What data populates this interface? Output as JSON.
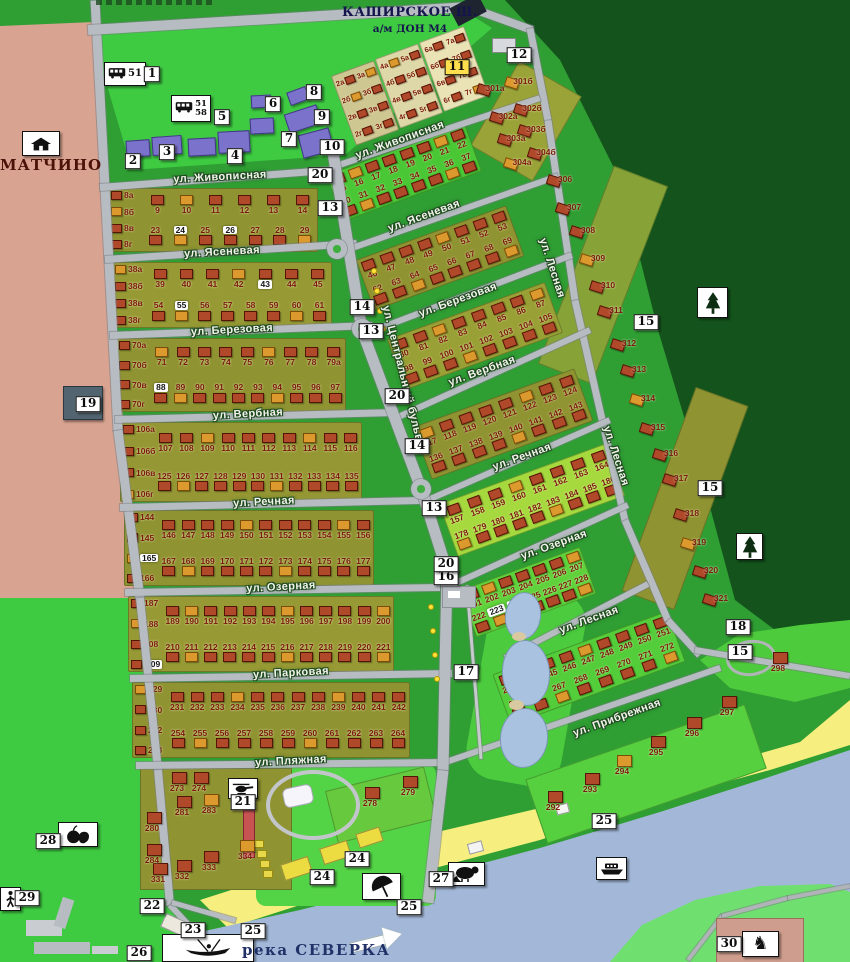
{
  "canvas": {
    "width": 850,
    "height": 962
  },
  "palette": {
    "grass_bright": "#3ecb42",
    "grass_mid": "#2f9e33",
    "forest": "#14541c",
    "settlement_pink": "#d8a391",
    "water": "#a3b8d8",
    "beach": "#f6ee7e",
    "road": "#b7bcc2",
    "plot_olive": "#8f9331",
    "plot_lime": "#b6e33c",
    "plot_green": "#46c834",
    "house_brick": "#b0482a",
    "house_orange": "#dc9a2e",
    "building_violet": "#7b72cc",
    "number_maroon": "#7a190d",
    "label_navy": "#15154d"
  },
  "header": {
    "highway": "КАШИРСКОЕ Ш.",
    "highway_sub": "а/м ДОН М4"
  },
  "places": {
    "village": "МАТЧИНО",
    "river": "река СЕВЕРКА"
  },
  "bus_stops": [
    {
      "routes": "51",
      "x": 104,
      "y": 62,
      "w": 42,
      "h": 24
    },
    {
      "routes": "51/58",
      "x": 171,
      "y": 95,
      "w": 40,
      "h": 27
    }
  ],
  "street_labels": [
    {
      "text": "ул. Живописная",
      "x": 220,
      "y": 177,
      "rot": -3
    },
    {
      "text": "ул. Ясеневая",
      "x": 222,
      "y": 252,
      "rot": -3
    },
    {
      "text": "ул. Березовая",
      "x": 232,
      "y": 330,
      "rot": -3
    },
    {
      "text": "ул. Вербная",
      "x": 248,
      "y": 414,
      "rot": -3
    },
    {
      "text": "ул. Речная",
      "x": 264,
      "y": 502,
      "rot": -3
    },
    {
      "text": "ул. Озерная",
      "x": 281,
      "y": 587,
      "rot": -3
    },
    {
      "text": "ул. Парковая",
      "x": 291,
      "y": 673,
      "rot": -3
    },
    {
      "text": "ул. Пляжная",
      "x": 291,
      "y": 761,
      "rot": -3
    },
    {
      "text": "ул. Живописная",
      "x": 400,
      "y": 140,
      "rot": -20
    },
    {
      "text": "ул. Ясеневая",
      "x": 424,
      "y": 216,
      "rot": -20
    },
    {
      "text": "ул. Березовая",
      "x": 458,
      "y": 300,
      "rot": -20
    },
    {
      "text": "ул. Вербная",
      "x": 482,
      "y": 371,
      "rot": -20
    },
    {
      "text": "ул. Речная",
      "x": 522,
      "y": 457,
      "rot": -20
    },
    {
      "text": "ул. Озерная",
      "x": 554,
      "y": 545,
      "rot": -20
    },
    {
      "text": "ул. Лесная",
      "x": 589,
      "y": 620,
      "rot": -20
    },
    {
      "text": "ул. Прибрежная",
      "x": 617,
      "y": 718,
      "rot": -20
    },
    {
      "text": "ул. Центральный бульвар",
      "x": 404,
      "y": 380,
      "rot": 76
    },
    {
      "text": "ул. Лесная",
      "x": 552,
      "y": 268,
      "rot": 72
    },
    {
      "text": "ул. Лесная",
      "x": 616,
      "y": 456,
      "rot": 72
    }
  ],
  "markers": [
    {
      "n": "1",
      "x": 152,
      "y": 74
    },
    {
      "n": "2",
      "x": 133,
      "y": 161
    },
    {
      "n": "3",
      "x": 167,
      "y": 152
    },
    {
      "n": "4",
      "x": 235,
      "y": 156
    },
    {
      "n": "5",
      "x": 222,
      "y": 117
    },
    {
      "n": "6",
      "x": 273,
      "y": 104
    },
    {
      "n": "7",
      "x": 289,
      "y": 139
    },
    {
      "n": "8",
      "x": 314,
      "y": 92
    },
    {
      "n": "9",
      "x": 322,
      "y": 117
    },
    {
      "n": "10",
      "x": 332,
      "y": 147
    },
    {
      "n": "11",
      "x": 457,
      "y": 67,
      "accent": true
    },
    {
      "n": "12",
      "x": 519,
      "y": 55
    },
    {
      "n": "13",
      "x": 330,
      "y": 208
    },
    {
      "n": "13",
      "x": 371,
      "y": 331
    },
    {
      "n": "13",
      "x": 434,
      "y": 508
    },
    {
      "n": "14",
      "x": 362,
      "y": 307
    },
    {
      "n": "14",
      "x": 417,
      "y": 446
    },
    {
      "n": "15",
      "x": 646,
      "y": 322
    },
    {
      "n": "15",
      "x": 710,
      "y": 488
    },
    {
      "n": "15",
      "x": 740,
      "y": 652
    },
    {
      "n": "16",
      "x": 446,
      "y": 577
    },
    {
      "n": "17",
      "x": 466,
      "y": 672
    },
    {
      "n": "18",
      "x": 738,
      "y": 627
    },
    {
      "n": "19",
      "x": 88,
      "y": 404
    },
    {
      "n": "20",
      "x": 320,
      "y": 175
    },
    {
      "n": "20",
      "x": 397,
      "y": 396
    },
    {
      "n": "20",
      "x": 446,
      "y": 564
    },
    {
      "n": "21",
      "x": 243,
      "y": 802
    },
    {
      "n": "22",
      "x": 152,
      "y": 906
    },
    {
      "n": "23",
      "x": 193,
      "y": 930
    },
    {
      "n": "24",
      "x": 357,
      "y": 859
    },
    {
      "n": "24",
      "x": 322,
      "y": 877
    },
    {
      "n": "25",
      "x": 604,
      "y": 821
    },
    {
      "n": "25",
      "x": 409,
      "y": 907
    },
    {
      "n": "25",
      "x": 253,
      "y": 931
    },
    {
      "n": "26",
      "x": 139,
      "y": 953
    },
    {
      "n": "27",
      "x": 441,
      "y": 879
    },
    {
      "n": "28",
      "x": 48,
      "y": 841
    },
    {
      "n": "29",
      "x": 27,
      "y": 898
    },
    {
      "n": "30",
      "x": 729,
      "y": 944
    }
  ],
  "icon_boxes": [
    {
      "icon": "house-icon",
      "x": 22,
      "y": 131,
      "w": 38,
      "h": 25
    },
    {
      "icon": "tree-icon",
      "x": 697,
      "y": 287,
      "w": 31,
      "h": 31
    },
    {
      "icon": "tree-icon",
      "x": 736,
      "y": 533,
      "w": 27,
      "h": 27
    },
    {
      "icon": "helicopter-icon",
      "x": 228,
      "y": 778,
      "w": 30,
      "h": 21
    },
    {
      "icon": "produce-icon",
      "x": 58,
      "y": 822,
      "w": 40,
      "h": 25
    },
    {
      "icon": "pedestrian-icon",
      "x": 0,
      "y": 887,
      "w": 21,
      "h": 24
    },
    {
      "icon": "beaver-icon",
      "x": 448,
      "y": 862,
      "w": 37,
      "h": 24
    },
    {
      "icon": "umbrella-icon",
      "x": 362,
      "y": 873,
      "w": 39,
      "h": 27
    },
    {
      "icon": "boat-icon",
      "x": 596,
      "y": 857,
      "w": 31,
      "h": 23
    },
    {
      "icon": "horse-icon",
      "x": 742,
      "y": 931,
      "w": 37,
      "h": 26
    },
    {
      "icon": "rowboat-icon",
      "x": 162,
      "y": 934,
      "w": 92,
      "h": 28
    }
  ],
  "plots": {
    "highlighted": [
      "24",
      "26",
      "43",
      "55",
      "88",
      "165",
      "209",
      "223",
      "224",
      "244"
    ],
    "left_blocks": [
      {
        "x": 108,
        "y": 188,
        "w": 210,
        "h": 64,
        "bg": "#8f9331",
        "stack": [
          "8а",
          "8б",
          "8в",
          "8г"
        ],
        "row1": [
          "9",
          "10",
          "11",
          "12",
          "13",
          "14"
        ],
        "row2": [
          "23",
          "24",
          "25",
          "26",
          "27",
          "28",
          "29"
        ]
      },
      {
        "x": 112,
        "y": 262,
        "w": 220,
        "h": 66,
        "bg": "#979a34",
        "stack": [
          "38а",
          "38б",
          "38в",
          "38г"
        ],
        "row1": [
          "39",
          "40",
          "41",
          "42",
          "43",
          "44",
          "45"
        ],
        "row2": [
          "54",
          "55",
          "56",
          "57",
          "58",
          "59",
          "60",
          "61"
        ]
      },
      {
        "x": 116,
        "y": 338,
        "w": 230,
        "h": 74,
        "bg": "#8f9331",
        "stack": [
          "70а",
          "70б",
          "70в",
          "70г"
        ],
        "row1": [
          "71",
          "72",
          "73",
          "74",
          "75",
          "76",
          "77",
          "78",
          "79а"
        ],
        "row2": [
          "88",
          "89",
          "90",
          "91",
          "92",
          "93",
          "94",
          "95",
          "96",
          "97"
        ]
      },
      {
        "x": 120,
        "y": 422,
        "w": 242,
        "h": 80,
        "bg": "#949733",
        "stack": [
          "106а",
          "106б",
          "106в",
          "106г"
        ],
        "row1": [
          "107",
          "108",
          "109",
          "110",
          "111",
          "112",
          "113",
          "114",
          "115",
          "116"
        ],
        "row2": [
          "125",
          "126",
          "127",
          "128",
          "129",
          "130",
          "131",
          "132",
          "133",
          "134",
          "135"
        ]
      },
      {
        "x": 124,
        "y": 510,
        "w": 250,
        "h": 76,
        "bg": "#8f9331",
        "st​ack_note": "",
        "stack": [
          "144",
          "145",
          "165",
          "166"
        ],
        "row1": [
          "146",
          "147",
          "148",
          "149",
          "150",
          "151",
          "152",
          "153",
          "154",
          "155",
          "156"
        ],
        "row2": [
          "167",
          "168",
          "169",
          "170",
          "171",
          "172",
          "173",
          "174",
          "175",
          "176",
          "177"
        ]
      },
      {
        "x": 128,
        "y": 596,
        "w": 266,
        "h": 76,
        "bg": "#979a34",
        "stack": [
          "187",
          "188",
          "208",
          "209"
        ],
        "row1": [
          "189",
          "190",
          "191",
          "192",
          "193",
          "194",
          "195",
          "196",
          "197",
          "198",
          "199",
          "200"
        ],
        "row2": [
          "210",
          "211",
          "212",
          "213",
          "214",
          "215",
          "216",
          "217",
          "218",
          "219",
          "220",
          "221"
        ]
      },
      {
        "x": 132,
        "y": 682,
        "w": 278,
        "h": 76,
        "bg": "#8f9331",
        "stack": [
          "229",
          "230",
          "252",
          "253"
        ],
        "row1": [
          "231",
          "232",
          "233",
          "234",
          "235",
          "236",
          "237",
          "238",
          "239",
          "240",
          "241",
          "242"
        ],
        "row2": [
          "254",
          "255",
          "256",
          "257",
          "258",
          "259",
          "260",
          "261",
          "262",
          "263",
          "264"
        ]
      }
    ],
    "right_blocks": [
      {
        "cx": 404,
        "cy": 173,
        "w": 148,
        "h": 50,
        "rot": -20,
        "bg": "#4ac735",
        "row1": [
          "15",
          "16",
          "17",
          "18",
          "19",
          "20",
          "21",
          "22"
        ],
        "row2": [
          "30",
          "31",
          "32",
          "33",
          "34",
          "35",
          "36",
          "37"
        ]
      },
      {
        "cx": 440,
        "cy": 258,
        "w": 160,
        "h": 54,
        "rot": -20,
        "bg": "#8f9331",
        "row1": [
          "46",
          "47",
          "48",
          "49",
          "50",
          "51",
          "52",
          "53"
        ],
        "row2": [
          "62",
          "63",
          "64",
          "65",
          "66",
          "67",
          "68",
          "69"
        ]
      },
      {
        "cx": 475,
        "cy": 336,
        "w": 168,
        "h": 54,
        "rot": -20,
        "bg": "#99a035",
        "row1": [
          "80",
          "81",
          "82",
          "83",
          "84",
          "85",
          "86",
          "87"
        ],
        "row2": [
          "98",
          "99",
          "100",
          "101",
          "102",
          "103",
          "104",
          "105"
        ]
      },
      {
        "cx": 503,
        "cy": 424,
        "w": 172,
        "h": 56,
        "rot": -20,
        "bg": "#8f9331",
        "row1": [
          "117",
          "118",
          "119",
          "120",
          "121",
          "122",
          "123",
          "124"
        ],
        "row2": [
          "136",
          "137",
          "138",
          "139",
          "140",
          "141",
          "142",
          "143"
        ]
      },
      {
        "cx": 532,
        "cy": 500,
        "w": 178,
        "h": 56,
        "rot": -20,
        "bg": "#a6d93e",
        "row1": [
          "157",
          "158",
          "159",
          "160",
          "161",
          "162",
          "163",
          "164"
        ],
        "row2": [
          "178",
          "179",
          "180",
          "181",
          "182",
          "183",
          "184",
          "185",
          "186"
        ]
      },
      {
        "cx": 528,
        "cy": 592,
        "w": 128,
        "h": 50,
        "rot": -20,
        "bg": "#5fd23b",
        "row1": [
          "201",
          "202",
          "203",
          "204",
          "205",
          "206",
          "207"
        ],
        "row2": [
          "222",
          "223",
          "224",
          "225",
          "226",
          "227",
          "228"
        ]
      },
      {
        "cx": 589,
        "cy": 668,
        "w": 186,
        "h": 54,
        "rot": -20,
        "bg": "#54cd3a",
        "row1": [
          "243",
          "244",
          "245",
          "246",
          "247",
          "248",
          "249",
          "250",
          "251"
        ],
        "row2": [
          "265",
          "266",
          "267",
          "268",
          "269",
          "270",
          "271",
          "272"
        ]
      }
    ],
    "north_blocks": [
      {
        "x": 342,
        "y": 66,
        "w": 46,
        "h": 74,
        "rot": -20,
        "bg": "#cfc792",
        "colA": [
          "2а",
          "2б",
          "2в",
          "2г"
        ],
        "colB": [
          "3а",
          "3б",
          "3в",
          "3г"
        ]
      },
      {
        "x": 386,
        "y": 49,
        "w": 46,
        "h": 74,
        "rot": -20,
        "bg": "#ded8a8",
        "colA": [
          "4а",
          "4б",
          "4в",
          "4г"
        ],
        "colB": [
          "5а",
          "5б",
          "5в",
          "5г"
        ]
      },
      {
        "x": 430,
        "y": 32,
        "w": 48,
        "h": 74,
        "rot": -20,
        "bg": "#e9e3b6",
        "colA": [
          "6а",
          "6б",
          "6в",
          "6г"
        ],
        "colB": [
          "7а",
          "7б",
          "7в",
          "7г"
        ]
      }
    ],
    "east_plots": [
      {
        "n": "301а",
        "x": 495,
        "y": 88
      },
      {
        "n": "301б",
        "x": 523,
        "y": 81
      },
      {
        "n": "302а",
        "x": 508,
        "y": 116
      },
      {
        "n": "302б",
        "x": 532,
        "y": 108
      },
      {
        "n": "303а",
        "x": 516,
        "y": 138
      },
      {
        "n": "303б",
        "x": 536,
        "y": 129
      },
      {
        "n": "304а",
        "x": 522,
        "y": 162
      },
      {
        "n": "304б",
        "x": 546,
        "y": 152
      },
      {
        "n": "306",
        "x": 565,
        "y": 179
      },
      {
        "n": "307",
        "x": 574,
        "y": 207
      },
      {
        "n": "308",
        "x": 588,
        "y": 230
      },
      {
        "n": "309",
        "x": 598,
        "y": 258
      },
      {
        "n": "310",
        "x": 608,
        "y": 285
      },
      {
        "n": "311",
        "x": 616,
        "y": 310
      },
      {
        "n": "312",
        "x": 629,
        "y": 343
      },
      {
        "n": "313",
        "x": 639,
        "y": 369
      },
      {
        "n": "314",
        "x": 648,
        "y": 398
      },
      {
        "n": "315",
        "x": 658,
        "y": 427
      },
      {
        "n": "316",
        "x": 671,
        "y": 453
      },
      {
        "n": "317",
        "x": 681,
        "y": 478
      },
      {
        "n": "318",
        "x": 692,
        "y": 513
      },
      {
        "n": "319",
        "x": 699,
        "y": 542
      },
      {
        "n": "320",
        "x": 711,
        "y": 570
      },
      {
        "n": "321",
        "x": 721,
        "y": 598
      }
    ],
    "south_plots": [
      {
        "n": "273",
        "x": 177,
        "y": 788
      },
      {
        "n": "274",
        "x": 199,
        "y": 788
      },
      {
        "n": "280",
        "x": 152,
        "y": 828
      },
      {
        "n": "281",
        "x": 182,
        "y": 812
      },
      {
        "n": "283",
        "x": 209,
        "y": 810
      },
      {
        "n": "284",
        "x": 152,
        "y": 860
      },
      {
        "n": "331",
        "x": 158,
        "y": 879
      },
      {
        "n": "332",
        "x": 182,
        "y": 876
      },
      {
        "n": "333",
        "x": 209,
        "y": 867
      },
      {
        "n": "334",
        "x": 245,
        "y": 856
      },
      {
        "n": "278",
        "x": 370,
        "y": 803
      },
      {
        "n": "279",
        "x": 408,
        "y": 792
      },
      {
        "n": "292",
        "x": 553,
        "y": 807
      },
      {
        "n": "293",
        "x": 590,
        "y": 789
      },
      {
        "n": "294",
        "x": 622,
        "y": 771
      },
      {
        "n": "295",
        "x": 656,
        "y": 752
      },
      {
        "n": "296",
        "x": 692,
        "y": 733
      },
      {
        "n": "297",
        "x": 727,
        "y": 712
      },
      {
        "n": "298",
        "x": 778,
        "y": 668
      }
    ]
  }
}
